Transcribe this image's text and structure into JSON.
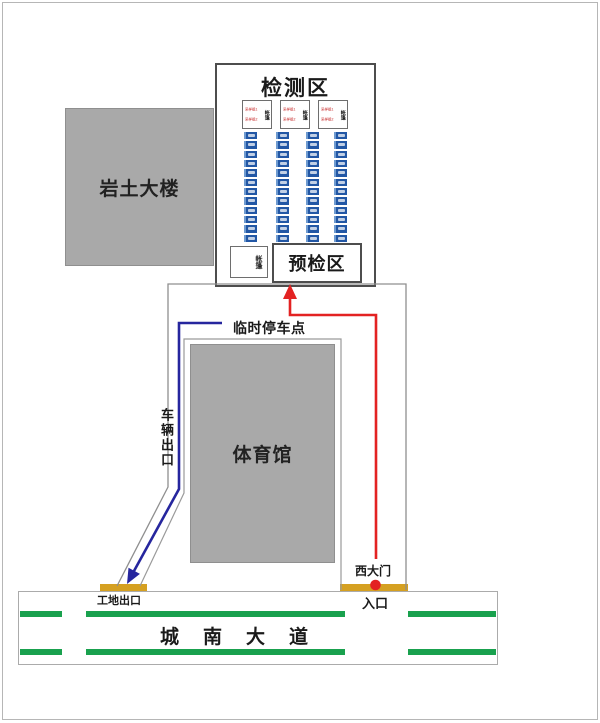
{
  "diagram": {
    "testing_area": {
      "title": "检测区"
    },
    "precheck": {
      "label": "预检区"
    },
    "tent": {
      "side_label": "帐篷",
      "station_line1": "采样组1",
      "station_line2": "采样组2"
    },
    "queues": {
      "lanes": 4,
      "segments_per_lane": 12
    },
    "buildings": {
      "geotech": "岩土大楼",
      "gym": "体育馆"
    },
    "labels": {
      "temp_parking": "临时停车点",
      "vehicle_exit": "车辆出口",
      "site_exit": "工地出口",
      "west_gate": "西大门",
      "entrance": "入口",
      "road": "城南大道"
    },
    "colors": {
      "lane_marking_green": "#19A14E",
      "gate_bar_orange": "#D5A021",
      "entry_route_red": "#E32222",
      "exit_route_blue": "#26269E",
      "building_gray": "#A9A9A9",
      "queue_blue": "#2257A5"
    }
  }
}
